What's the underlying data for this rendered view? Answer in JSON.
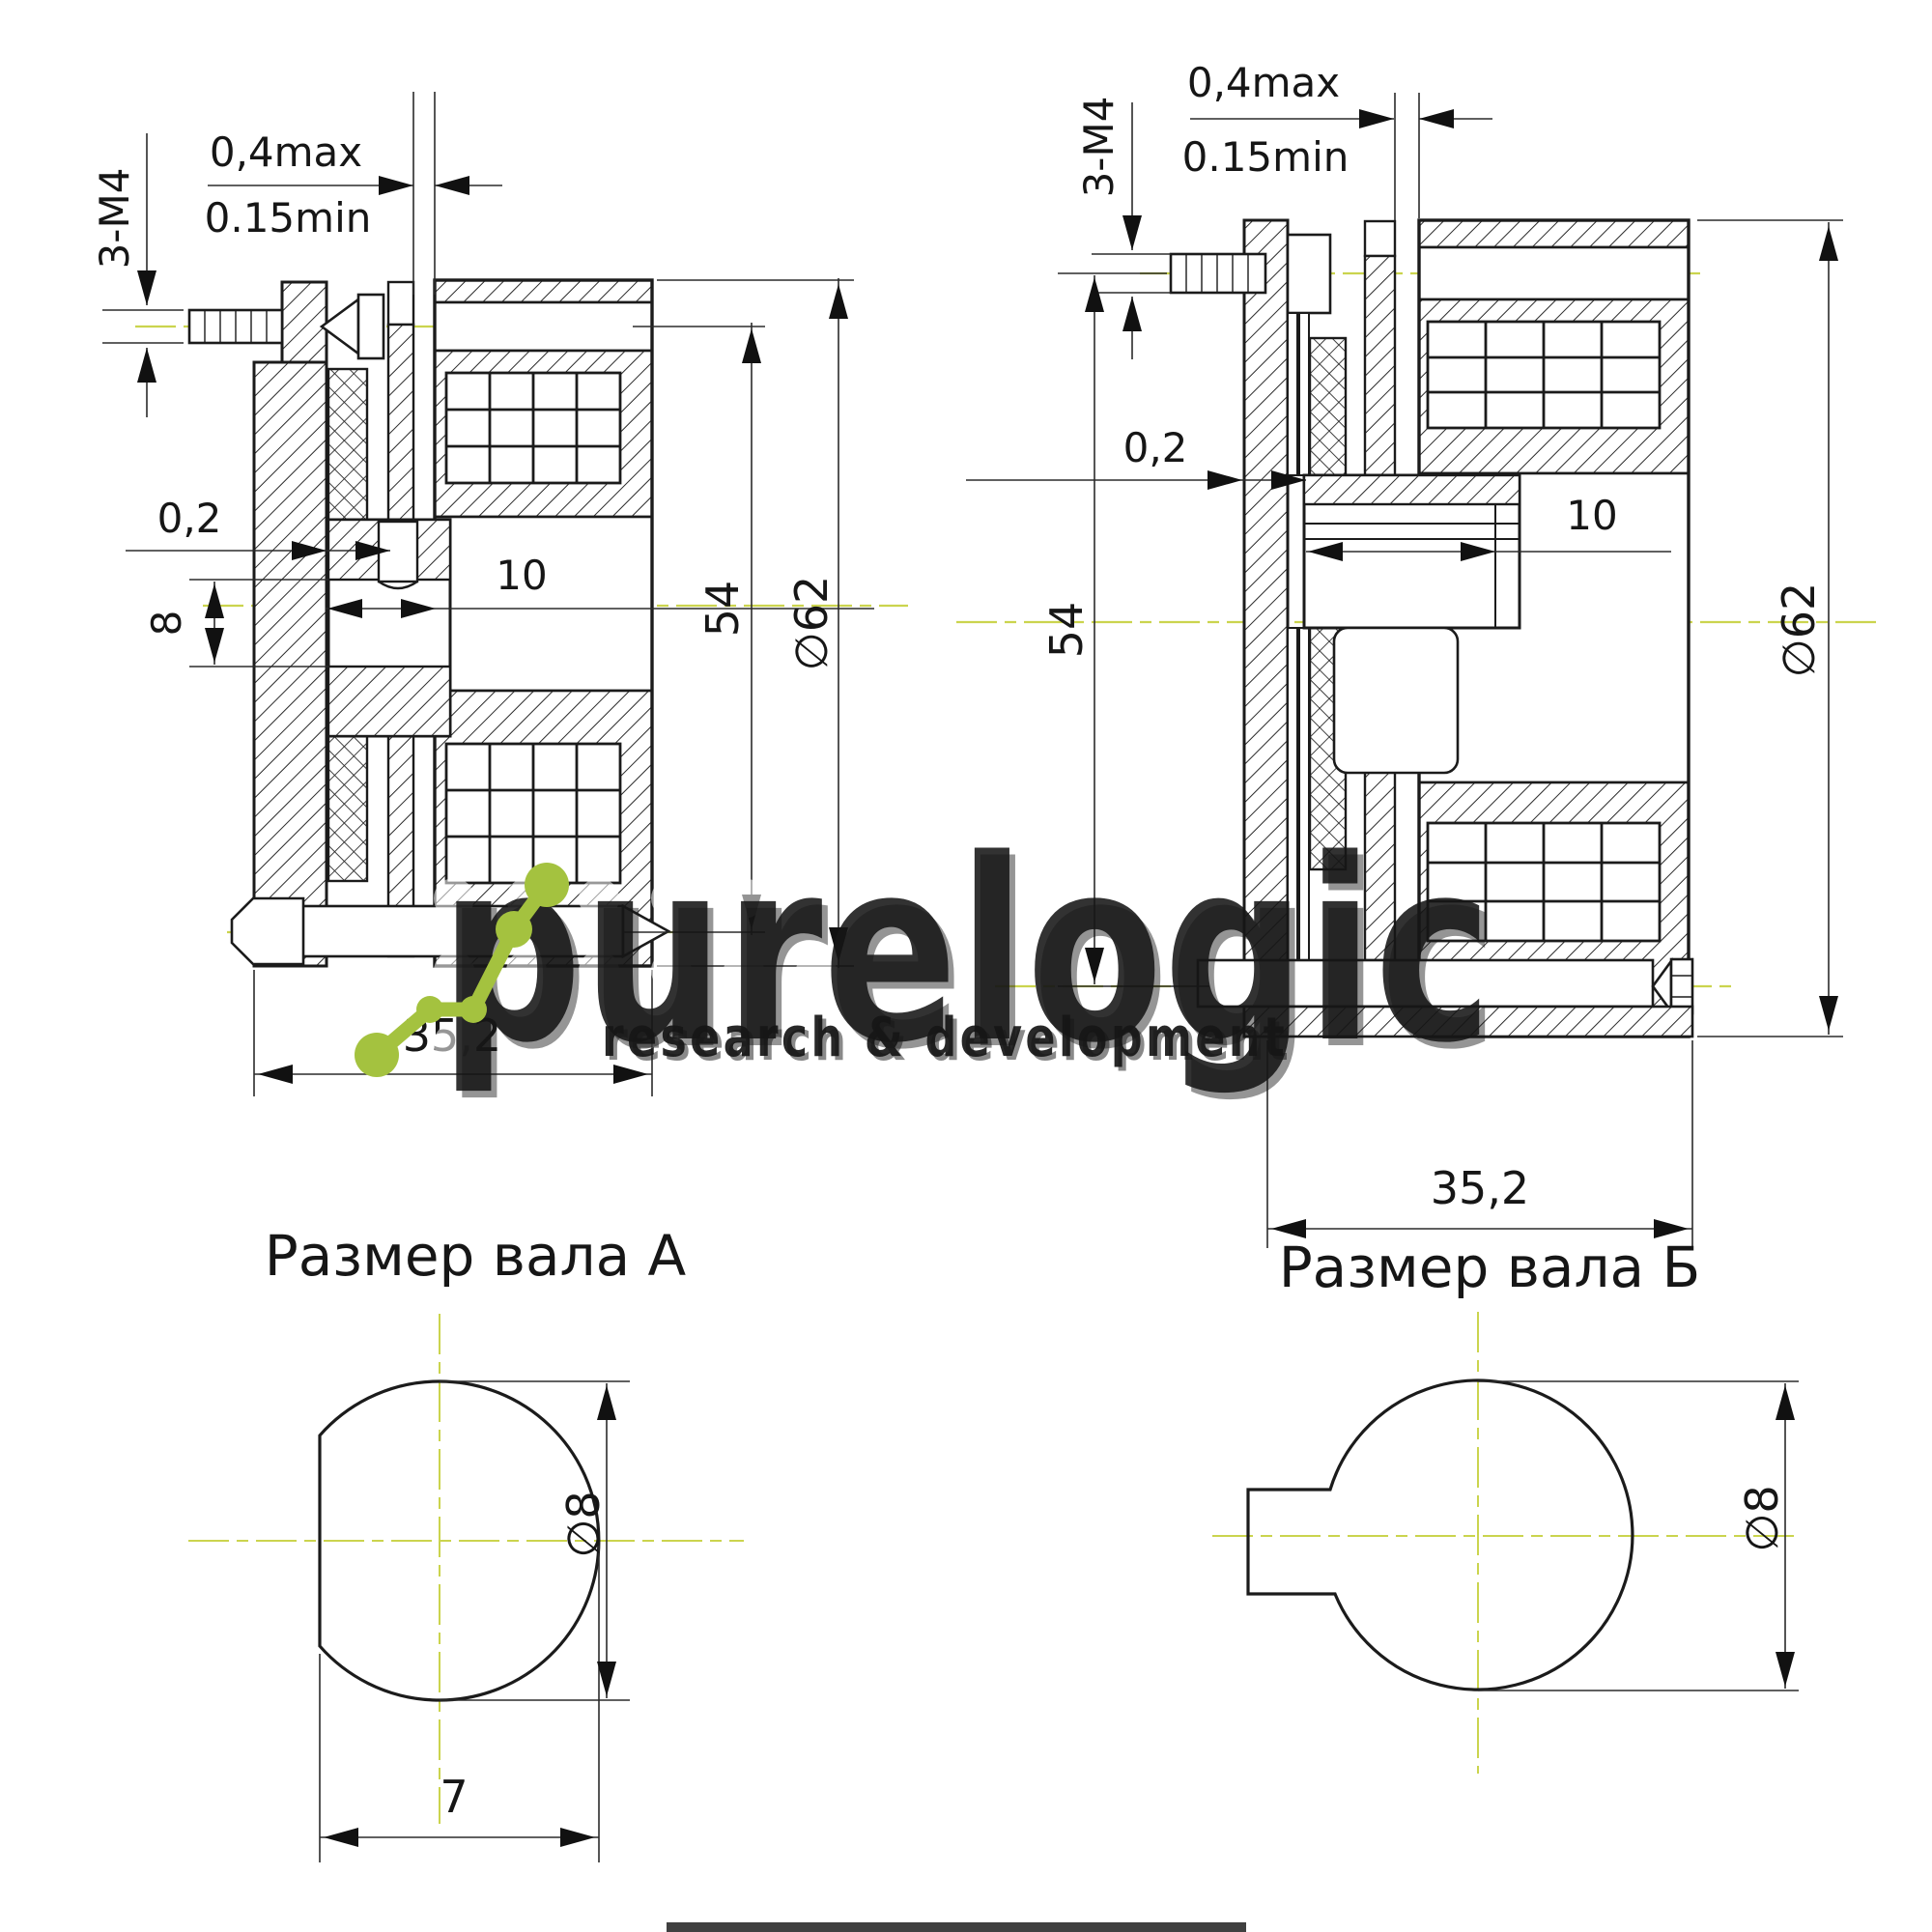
{
  "drawing": {
    "views": {
      "left": {
        "air_gap_max": "0,4max",
        "air_gap_min": "0.15min",
        "mount_thread": "3-М4",
        "clearance": "0,2",
        "shaft_dia": "8",
        "hub_bore_depth": "10",
        "bolt_circle_dia": "54",
        "outer_dia": "∅62",
        "overall_width": "35,2"
      },
      "right": {
        "air_gap_max": "0,4max",
        "air_gap_min": "0.15min",
        "mount_thread": "3-М4",
        "clearance": "0,2",
        "hub_bore_depth": "10",
        "bolt_circle_dia": "54",
        "outer_dia": "∅62",
        "overall_width": "35,2"
      }
    },
    "shaft_a": {
      "title": "Размер вала А",
      "dia": "∅8",
      "flat_width": "7"
    },
    "shaft_b": {
      "title": "Размер вала Б",
      "dia": "∅8"
    }
  },
  "watermark": {
    "brand": "purelogic",
    "tagline": "research & development"
  },
  "colors": {
    "centerline": "#cbd44e",
    "logo_green": "#a4c23f",
    "line": "#1b1b1b"
  }
}
